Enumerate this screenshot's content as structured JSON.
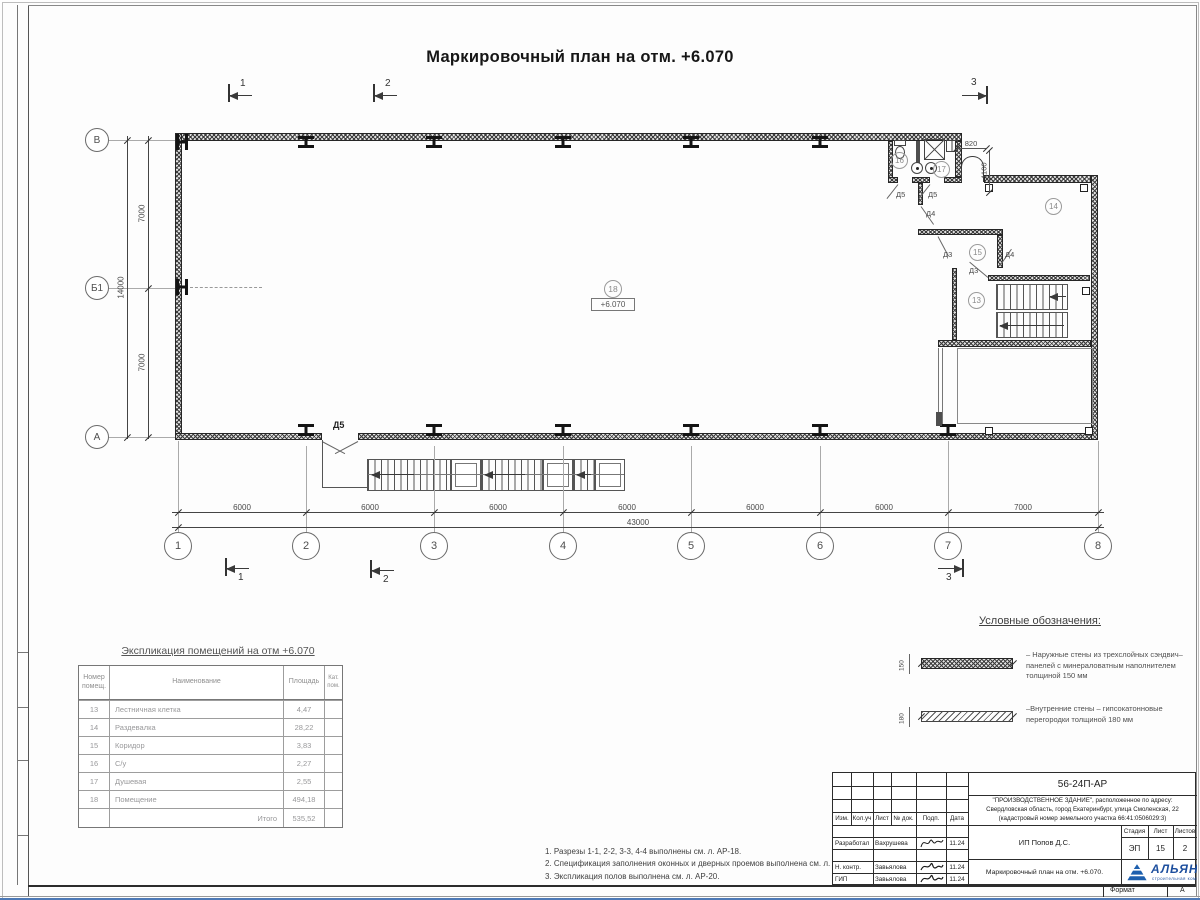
{
  "sheet": {
    "title": "Маркировочный план на отм. +6.070",
    "format_label": "Формат",
    "format_value": "А"
  },
  "plan": {
    "elevation": "+6.070",
    "axes_bottom": [
      "1",
      "2",
      "3",
      "4",
      "5",
      "6",
      "7",
      "8"
    ],
    "axes_left": [
      "В",
      "Б1",
      "А"
    ],
    "dims_bottom": [
      "6000",
      "6000",
      "6000",
      "6000",
      "6000",
      "6000",
      "7000"
    ],
    "dim_total_bottom": "43000",
    "dims_left": [
      "7000",
      "7000"
    ],
    "dim_total_left": "14000",
    "dim_opening_width": "820",
    "dim_opening_offset": "1100",
    "rooms": {
      "r13": "13",
      "r14": "14",
      "r15": "15",
      "r16": "16",
      "r17": "17",
      "r18": "18"
    },
    "doors": {
      "d3": "Д3",
      "d4": "Д4",
      "d5": "Д5"
    },
    "sections": {
      "s1": "1",
      "s2": "2",
      "s3": "3"
    }
  },
  "explication": {
    "title": "Экспликация помещений на отм +6.070",
    "headers": {
      "num1": "Номер",
      "num2": "помещ.",
      "name": "Наименование",
      "area": "Площадь",
      "cat1": "Кат.",
      "cat2": "пом."
    },
    "rows": [
      {
        "num": "13",
        "name": "Лестничная клетка",
        "area": "4,47"
      },
      {
        "num": "14",
        "name": "Раздевалка",
        "area": "28,22"
      },
      {
        "num": "15",
        "name": "Коридор",
        "area": "3,83"
      },
      {
        "num": "16",
        "name": "С/у",
        "area": "2,27"
      },
      {
        "num": "17",
        "name": "Душевая",
        "area": "2,55"
      },
      {
        "num": "18",
        "name": "Помещение",
        "area": "494,18"
      }
    ],
    "total_label": "Итого",
    "total_value": "535,52"
  },
  "legend": {
    "title": "Условные обозначения:",
    "items": [
      {
        "thickness": "150",
        "text": "–  Наружные стены из трехслойных сэндвич–панелей с минераловатным наполнителем толщиной 150 мм"
      },
      {
        "thickness": "180",
        "text": "–Внутренние стены – гипсокатонновые перегородки толщиной 180 мм"
      }
    ]
  },
  "notes": [
    "1. Разрезы 1-1, 2-2, 3-3, 4-4 выполнены см. л. АР-18.",
    "2. Спецификация заполнения оконных и дверных проемов выполнена см. л. АР-20.",
    "3. Экспликация полов выполнена см. л. АР-20."
  ],
  "titleblock": {
    "doc_number": "56-24П-АР",
    "address_lines": [
      "\"ПРОИЗВОДСТВЕННОЕ ЗДАНИЕ\", расположенное по адресу:",
      "Свердловская область, город Екатеринбург, улица Смоленская, 22",
      "(кадастровый номер земельного участка 66:41:0506029:3)"
    ],
    "header_cols": [
      "Изм.",
      "Кол.уч",
      "Лист",
      "№ док.",
      "Подп.",
      "Дата"
    ],
    "roles": [
      {
        "role": "Разработал",
        "name": "Вахрушева",
        "date": "11.24"
      },
      {
        "role": "Н. контр.",
        "name": "Завьялова",
        "date": "11.24"
      },
      {
        "role": "ГИП",
        "name": "Завьялова",
        "date": "11.24"
      }
    ],
    "client": "ИП Попов Д.С.",
    "stage_label": "Стадия",
    "sheet_label": "Лист",
    "sheets_label": "Листов",
    "stage": "ЭП",
    "sheet_no": "15",
    "sheets_total": "2",
    "project_name": "Маркировочный план на отм. +6.070.",
    "logo_text": "АЛЬЯНС",
    "logo_sub": "строительная компания"
  }
}
